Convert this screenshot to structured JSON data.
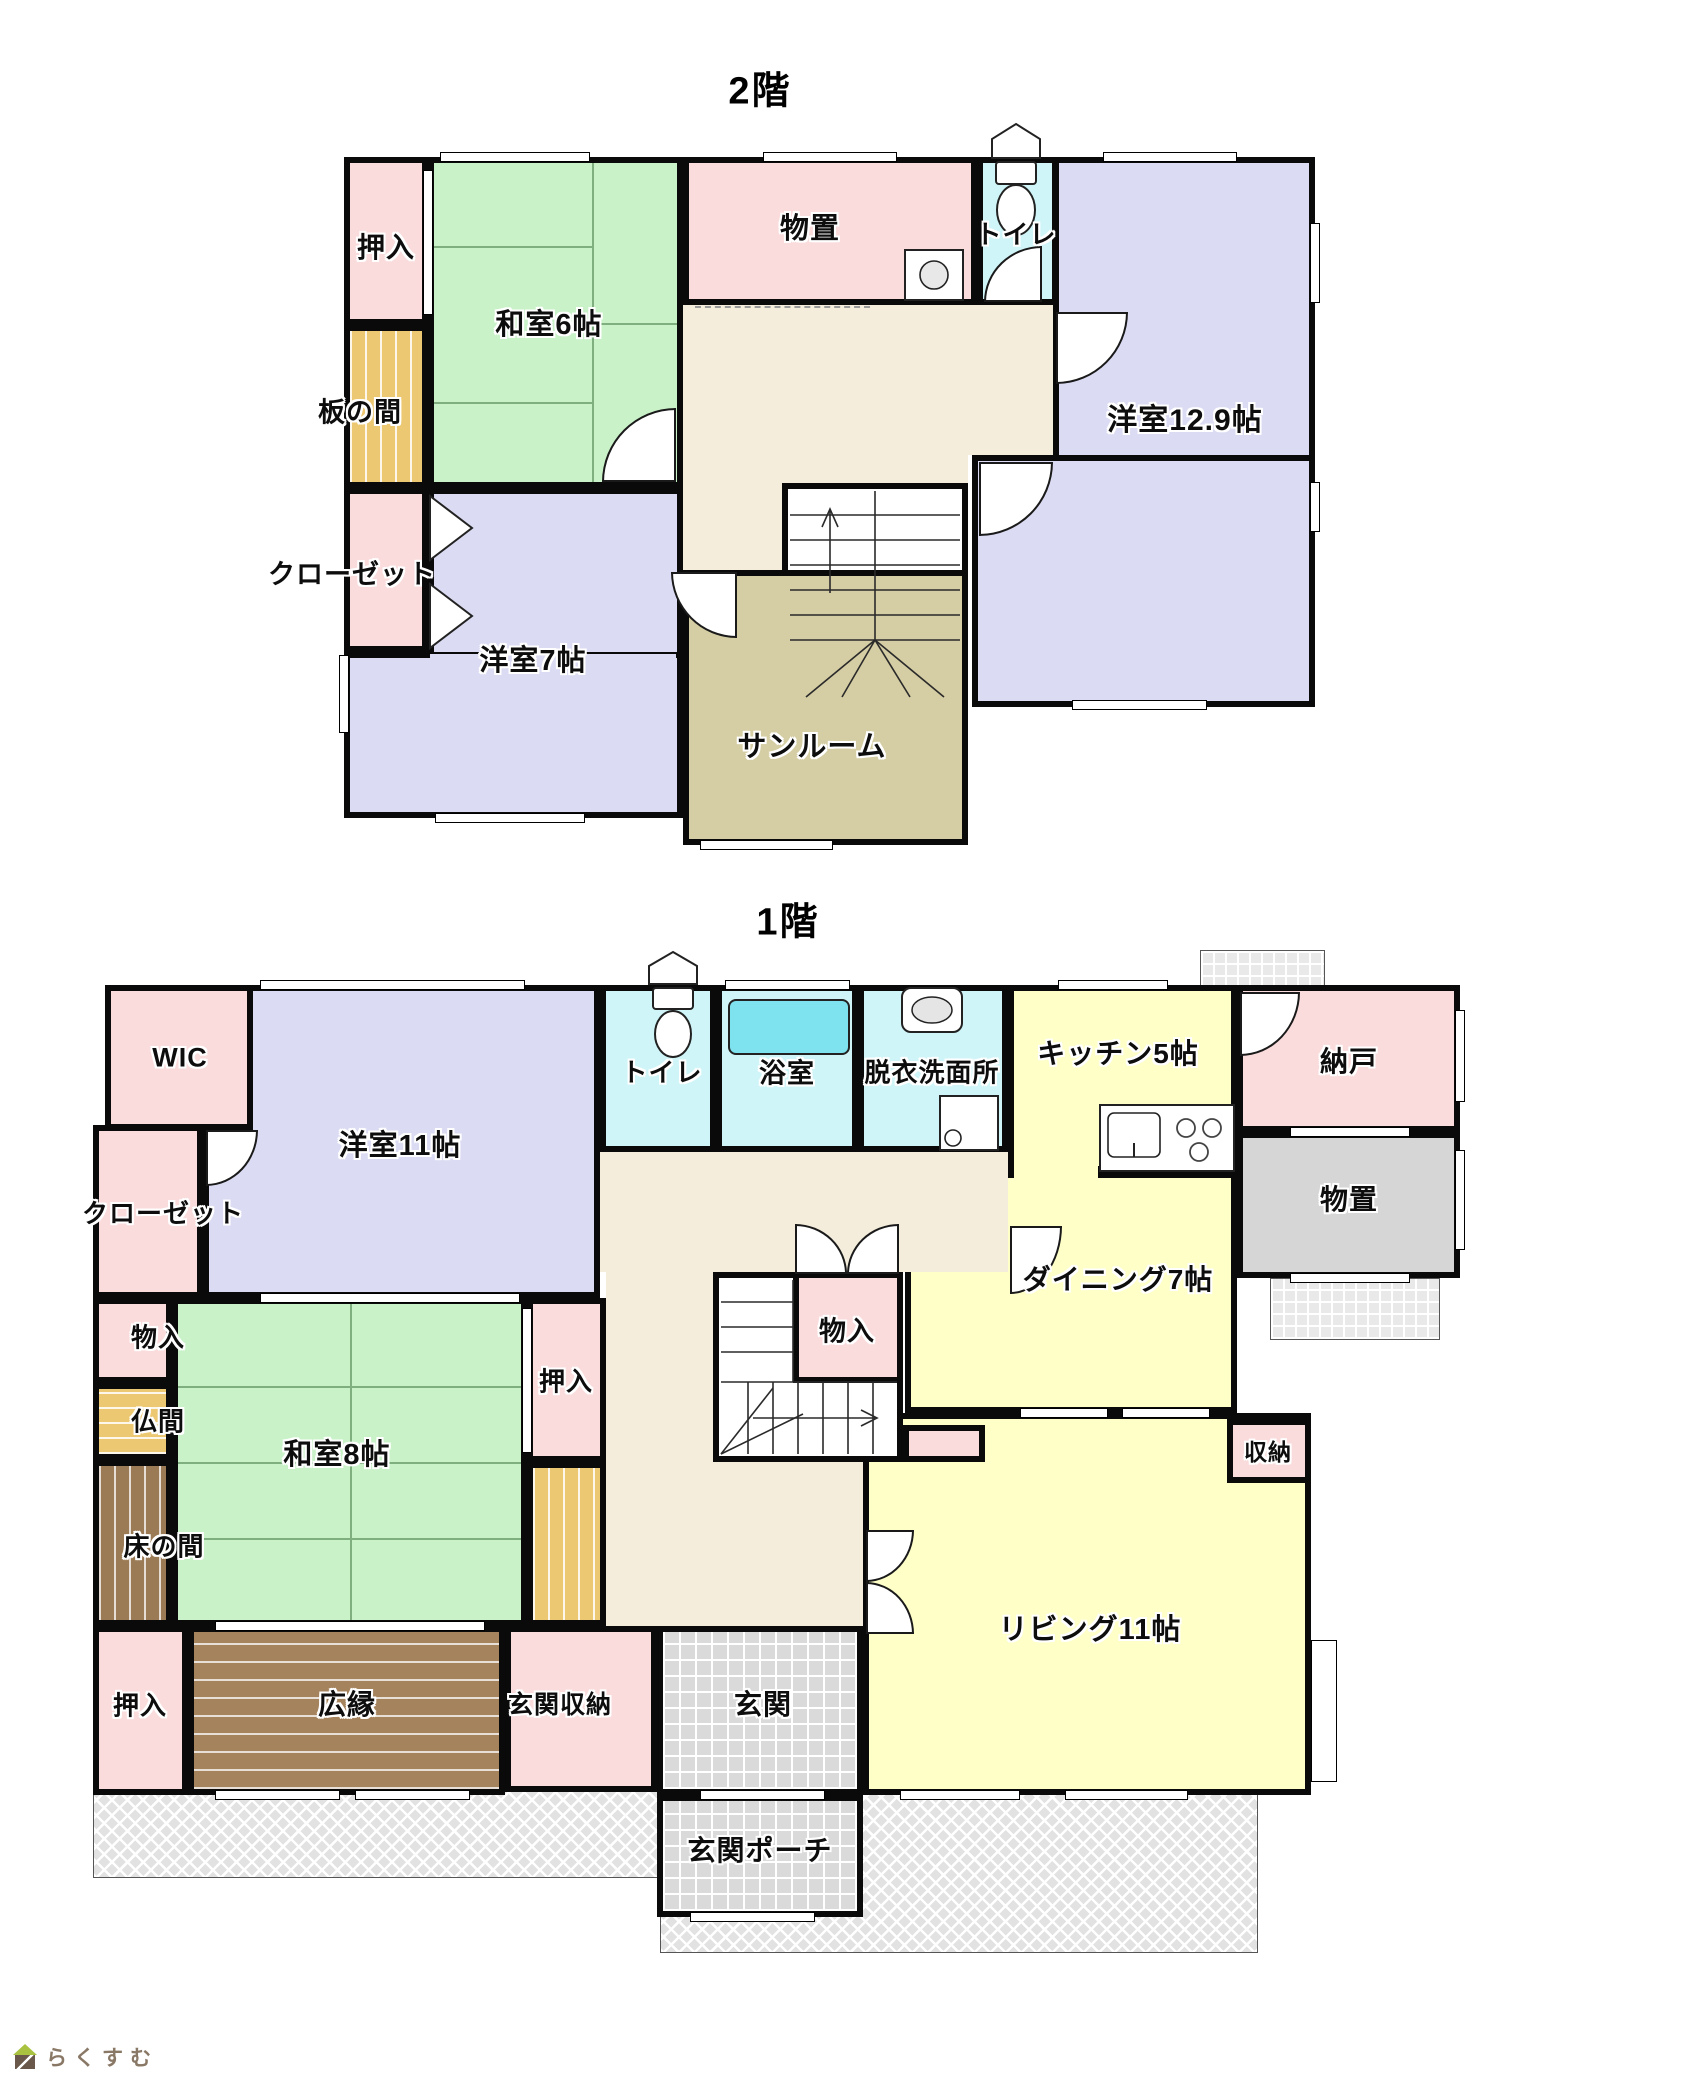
{
  "floor2": {
    "title": "2階",
    "rooms": {
      "oshiire": "押入",
      "washitsu6": "和室6帖",
      "itanoma": "板の間",
      "monooki": "物置",
      "toilet": "トイレ",
      "yoshitsu129": "洋室12.9帖",
      "closet": "クローゼット",
      "yoshitsu7": "洋室7帖",
      "sunroom": "サンルーム"
    }
  },
  "floor1": {
    "title": "1階",
    "rooms": {
      "wic": "WIC",
      "yoshitsu11": "洋室11帖",
      "toilet": "トイレ",
      "bath": "浴室",
      "datsui": "脱衣洗面所",
      "kitchen": "キッチン5帖",
      "nando": "納戸",
      "monooki": "物置",
      "closet": "クローゼット",
      "dining": "ダイニング7帖",
      "monoire": "物入",
      "monoire_left": "物入",
      "butsuma": "仏間",
      "washitsu8": "和室8帖",
      "oshiire_right": "押入",
      "tokonoma": "床の間",
      "shuno": "収納",
      "living": "リビング11帖",
      "oshiire_bottom": "押入",
      "hiroen": "広縁",
      "genkan_shuno": "玄関収納",
      "genkan": "玄関",
      "porch": "玄関ポーチ"
    }
  },
  "logo": {
    "text": "らくすむ",
    "icon": "house-icon"
  },
  "colors": {
    "wall": "#0a0a0a",
    "pink": "#fadcdc",
    "tatami": "#c9f2c9",
    "lavender": "#dbdbf3",
    "cyan": "#d0f5f8",
    "tub": "#7ee3ee",
    "yellow": "#ffffc8",
    "hall": "#f4eddb",
    "sunroom": "#d5cda3",
    "gold": "#edc873",
    "veranda_brown": "#a5835c",
    "tokonoma_brown": "#9b7b55",
    "gray_room": "#d6d6d6",
    "tile_gray": "#dadada",
    "terrace_gray": "#e9e9e9",
    "hatch_gray": "#e2e2e2",
    "white": "#ffffff"
  }
}
